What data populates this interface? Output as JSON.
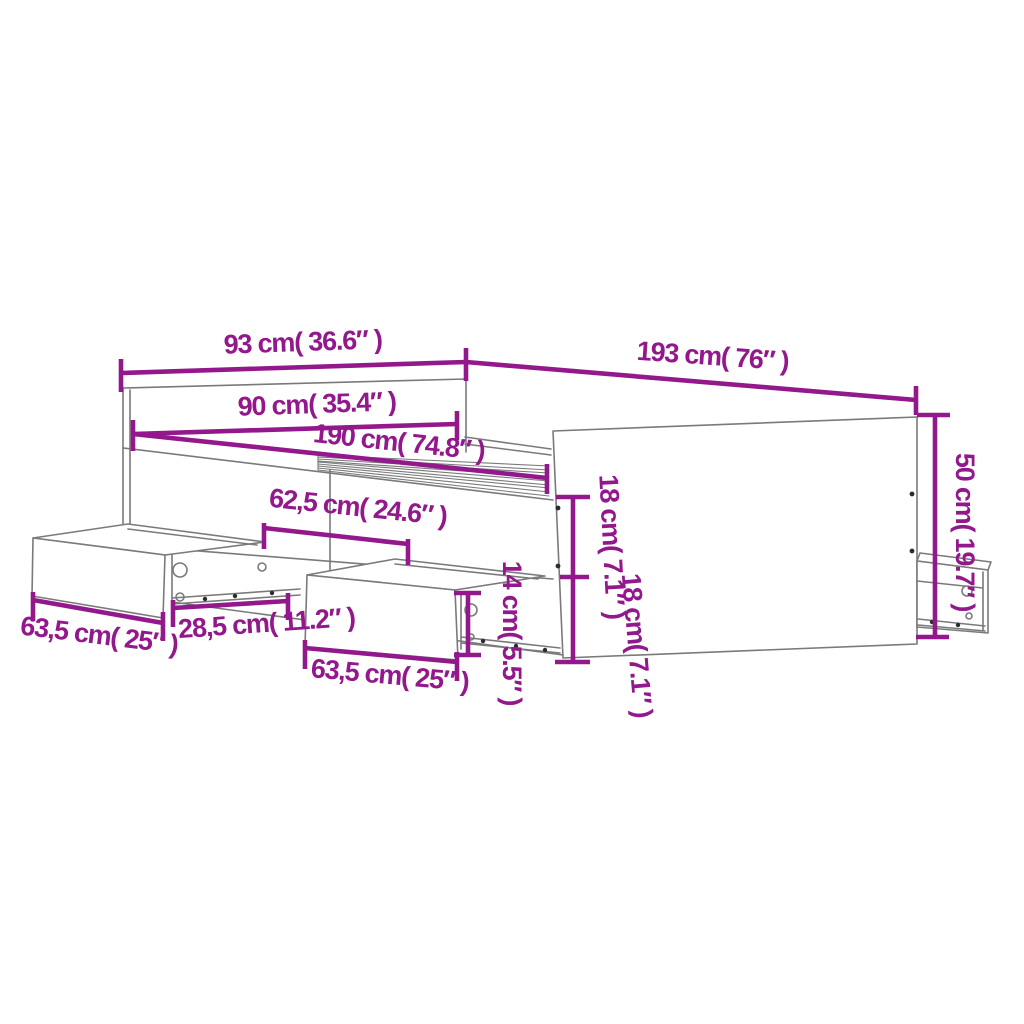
{
  "diagram": {
    "subject": "bed frame with storage drawers",
    "style": "technical line drawing with dimension annotations"
  },
  "colors": {
    "dimension": "#92188C",
    "outline": "#7a7a7a",
    "screw": "#2b2b2b"
  },
  "dimensions": [
    {
      "id": "overall-width",
      "label": "93 cm( 36.6″ )",
      "value_cm": "93",
      "value_inch": "36.6"
    },
    {
      "id": "overall-length",
      "label": "193 cm( 76″ )",
      "value_cm": "193",
      "value_inch": "76"
    },
    {
      "id": "inner-width",
      "label": "90 cm( 35.4″ )",
      "value_cm": "90",
      "value_inch": "35.4"
    },
    {
      "id": "inner-length",
      "label": "190 cm( 74.8″ )",
      "value_cm": "190",
      "value_inch": "74.8"
    },
    {
      "id": "drawer-span",
      "label": "62,5 cm( 24.6″ )",
      "value_cm": "62,5",
      "value_inch": "24.6"
    },
    {
      "id": "left-drawer-width",
      "label": "63,5 cm( 25″ )",
      "value_cm": "63,5",
      "value_inch": "25"
    },
    {
      "id": "drawer-gap",
      "label": "28,5 cm( 11.2″ )",
      "value_cm": "28,5",
      "value_inch": "11.2"
    },
    {
      "id": "middle-drawer-width",
      "label": "63,5 cm( 25″ )",
      "value_cm": "63,5",
      "value_inch": "25"
    },
    {
      "id": "footboard-height",
      "label": "50 cm( 19.7″ )",
      "value_cm": "50",
      "value_inch": "19.7"
    },
    {
      "id": "rail-height-upper",
      "label": "18 cm( 7.1″ )",
      "value_cm": "18",
      "value_inch": "7.1"
    },
    {
      "id": "rail-height-lower",
      "label": "18 cm( 7.1″ )",
      "value_cm": "18",
      "value_inch": "7.1"
    },
    {
      "id": "drawer-front-height",
      "label": "14 cm( 5.5″ )",
      "value_cm": "14",
      "value_inch": "5.5"
    }
  ]
}
